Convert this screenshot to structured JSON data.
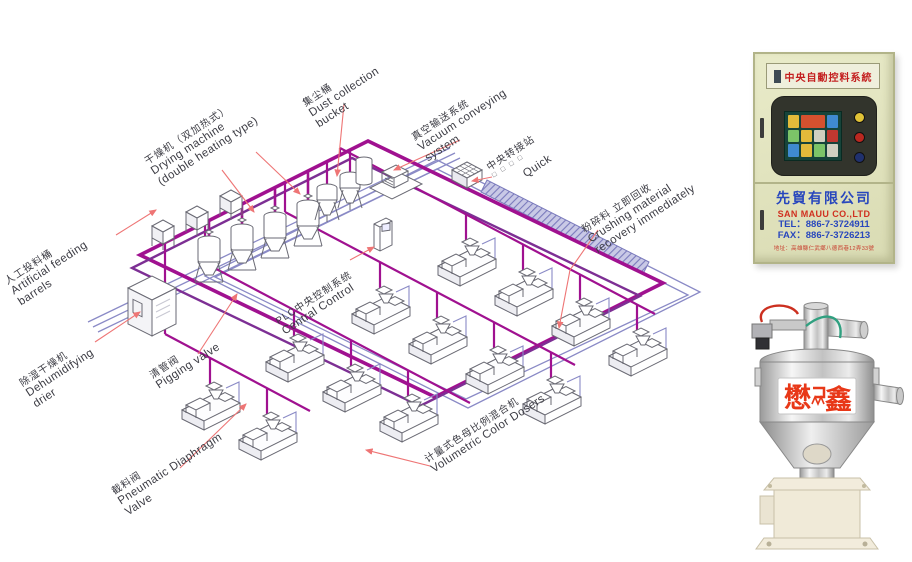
{
  "colors": {
    "pipe_magenta": "#a01190",
    "pipe_purple": "#7d2f94",
    "pipe_blue": "#8a8ac6",
    "leader_red": "#ee7575",
    "cabinet_body": "#e0e2bf",
    "brand_blue": "#2847bd",
    "brand_red": "#d03020",
    "loader_logo_red": "#e83818"
  },
  "diagram": {
    "labels": {
      "drying": {
        "l1": "干燥机（双加热式）",
        "l2": "Drying machine",
        "l3": "(double heating type)"
      },
      "dust": {
        "l1": "集尘桶",
        "l2": "Dust collection",
        "l3": "bucket"
      },
      "vacuum": {
        "l1": "真空输送系统",
        "l2": "Vacuum conveying",
        "l3": "system"
      },
      "transfer": {
        "l1": "中央转接站",
        "l2": "□ □ □ □"
      },
      "quick": {
        "l1": "Quick"
      },
      "crushing": {
        "l1": "粉碎料 立即回收",
        "l2": "Crushing material",
        "l3": "recovery immediately"
      },
      "feeding": {
        "l1": "人工投料桶",
        "l2": "Artificial feeding",
        "l3": "barrels"
      },
      "dehumidifying": {
        "l1": "除湿干燥机",
        "l2": "Dehumidifying",
        "l3": "drier"
      },
      "pigging": {
        "l1": "清管阀",
        "l2": "Pigging valve"
      },
      "plc": {
        "l1": "PLC中央控制系统",
        "l2": "Central Control"
      },
      "pneumatic": {
        "l1": "截料阀",
        "l2": "Pneumatic Diaphragm",
        "l3": "Valve"
      },
      "volumetric": {
        "l1": "计量式色母比例混合机",
        "l2": "Volumetric Color Dosers"
      }
    }
  },
  "cabinet": {
    "title": "中央自動控料系統",
    "company_cn": "先貿有限公司",
    "company_en": "SAN MAUU CO.,LTD",
    "tel": "TEL：886-7-3724911",
    "fax": "FAX：886-7-3726213",
    "address": "地址：高雄縣仁武鄉八德西巷12弄33號"
  },
  "loader": {
    "logo_left": "懋",
    "logo_right": "鑫"
  }
}
